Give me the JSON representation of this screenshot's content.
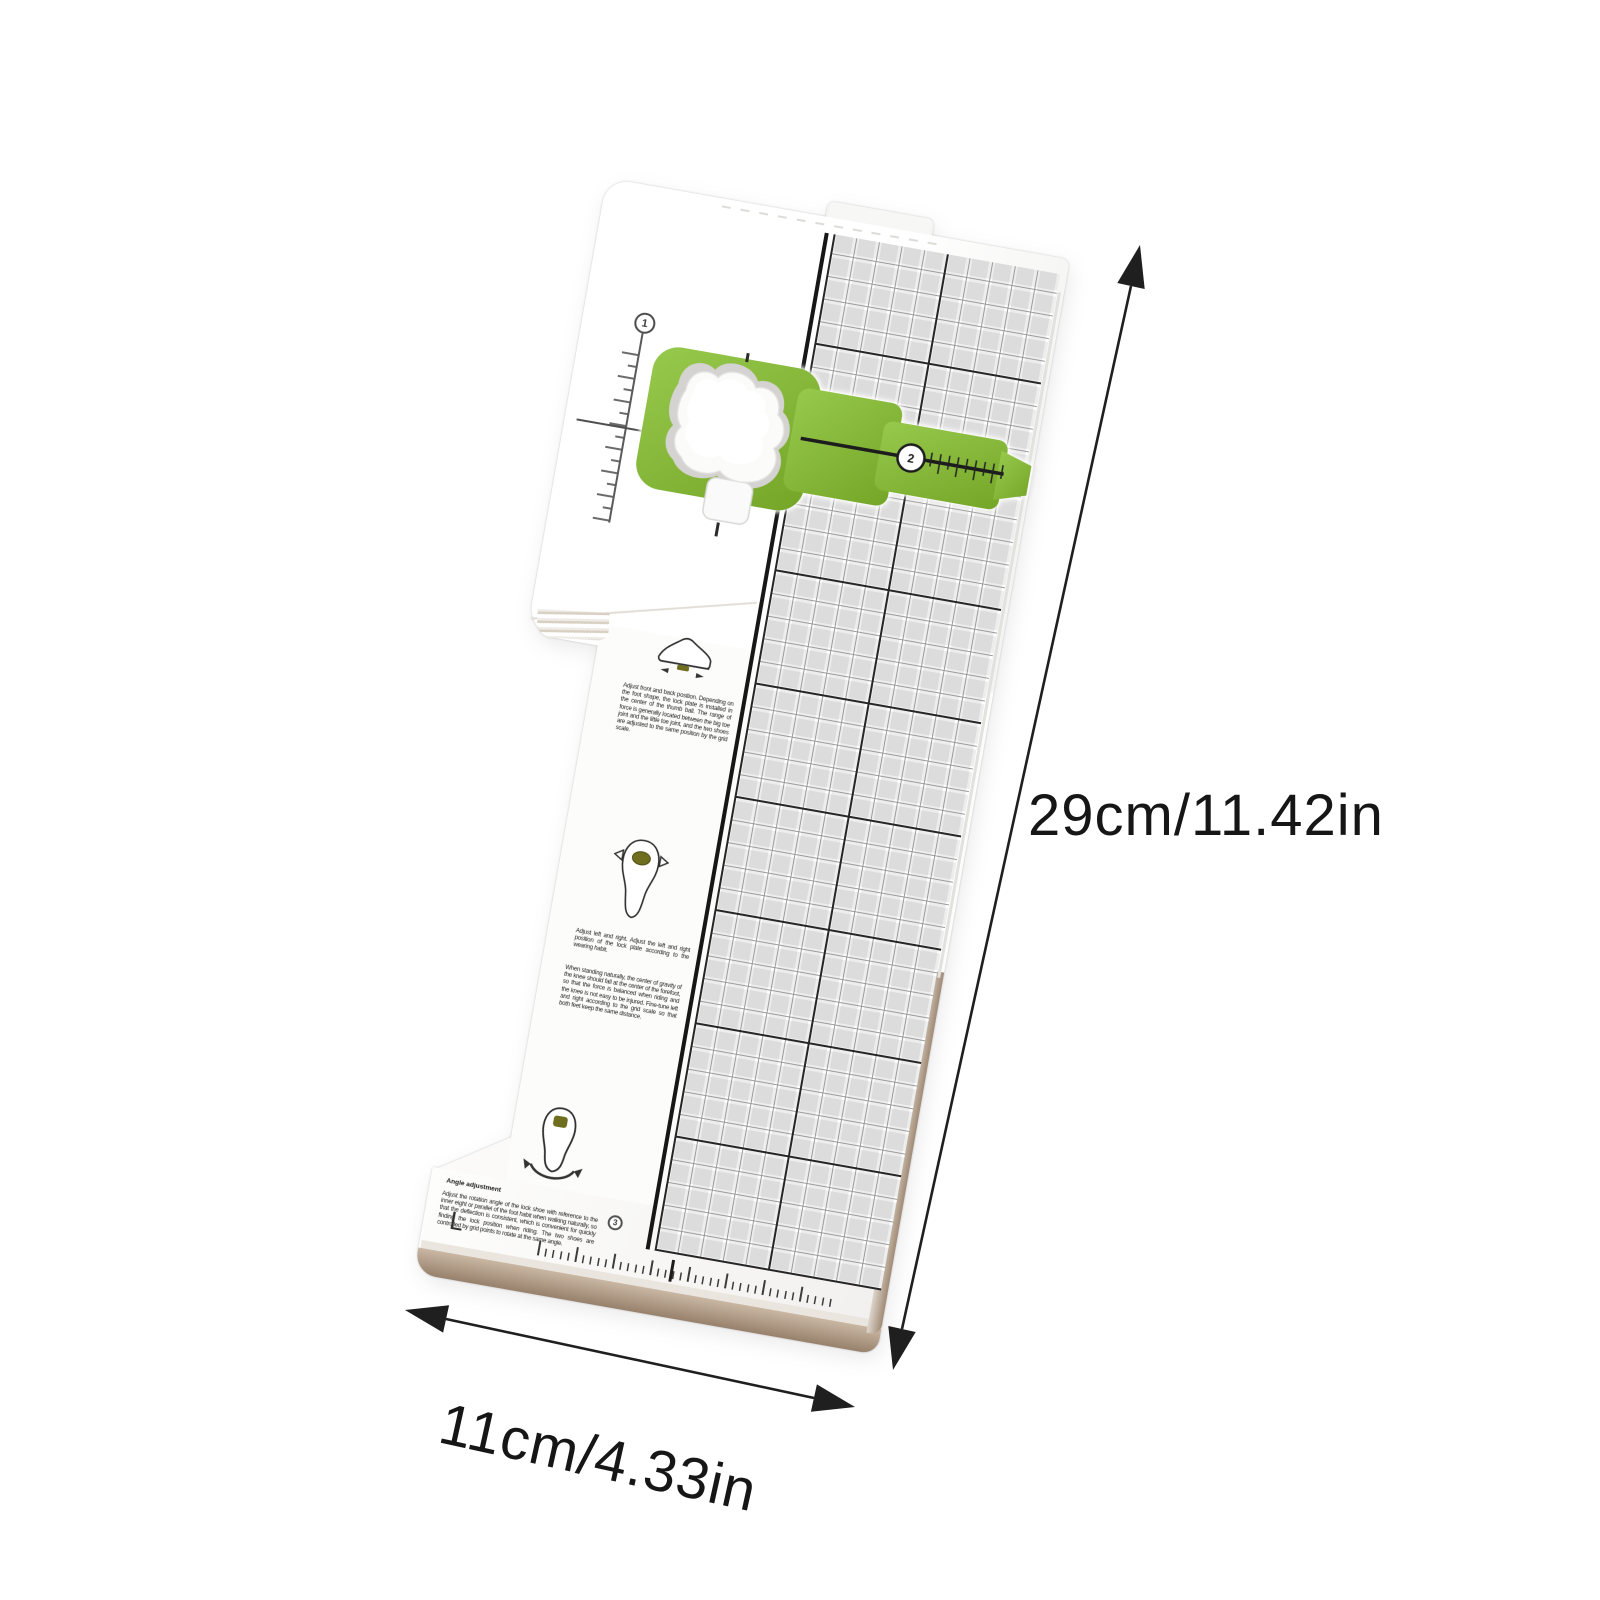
{
  "scene": {
    "background_color": "#ffffff"
  },
  "annotations": {
    "height_label": "29cm/11.42in",
    "width_label": "11cm/4.33in"
  },
  "board": {
    "side_label": "L",
    "markers": {
      "m1": "1",
      "m2": "2",
      "m3": "3"
    },
    "instructions": {
      "front_back": "Adjust front and back position. Depending on the foot shape, the lock plate is installed in the center of the thumb ball. The range of force is generally located between the big toe joint and the little toe joint, and the two shoes are adjusted to the same position by the grid scale.",
      "left_right": "Adjust left and right. Adjust the left and right position of the lock plate according to the wearing habit.",
      "left_right_detail": "When standing naturally, the center of gravity of the knee should fall at the center of the forefoot, so that the force is balanced when riding and the knee is not easy to be injured. Fine-tune left and right according to the grid scale so that both feet keep the same distance.",
      "angle_title": "Angle adjustment",
      "angle_body": "Adjust the rotation angle of the lock shoe with reference to the inner eight or parallel of the foot habit when walking naturally, so that the deflection is consistent, which is convenient for quickly finding the lock position when riding. The two shoes are controlled by grid points to rotate at the same angle."
    },
    "colors": {
      "plate_green": "#7fb232",
      "cleat_olive": "#6f6e1e",
      "edge_tan": "#a08a75",
      "grid_major": "#262626",
      "grid_minor": "#9b9b9b"
    }
  },
  "icons": [
    "shoe-side-icon",
    "shoe-sole-icon",
    "shoe-rotation-icon"
  ]
}
